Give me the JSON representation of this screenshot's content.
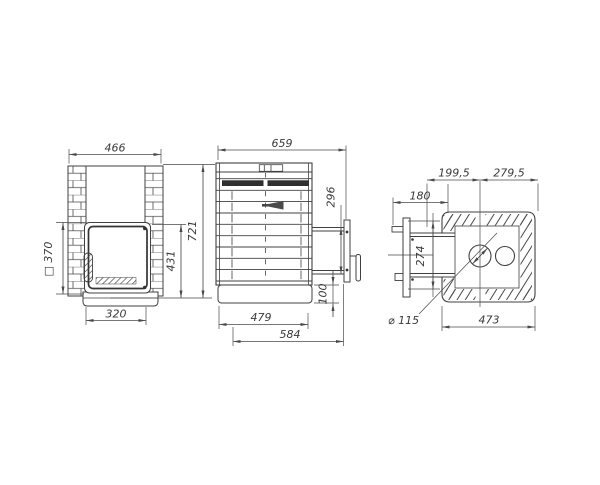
{
  "drawing": {
    "background": "#ffffff",
    "line_color": "#404040",
    "views": {
      "front": {
        "dims": {
          "total_width": "466",
          "opening": "□ 370",
          "base_width": "320",
          "door_height": "431",
          "total_height": "721"
        }
      },
      "side": {
        "dims": {
          "total_depth": "659",
          "frame_height": "296",
          "base_height": "100",
          "body_depth": "479",
          "overall_depth": "584"
        }
      },
      "top": {
        "dims": {
          "left_offset": "199,5",
          "right_offset": "279,5",
          "tunnel_length": "180",
          "frame_width": "274",
          "chimney_diameter": "⌀ 115",
          "total_width": "473"
        }
      }
    }
  }
}
